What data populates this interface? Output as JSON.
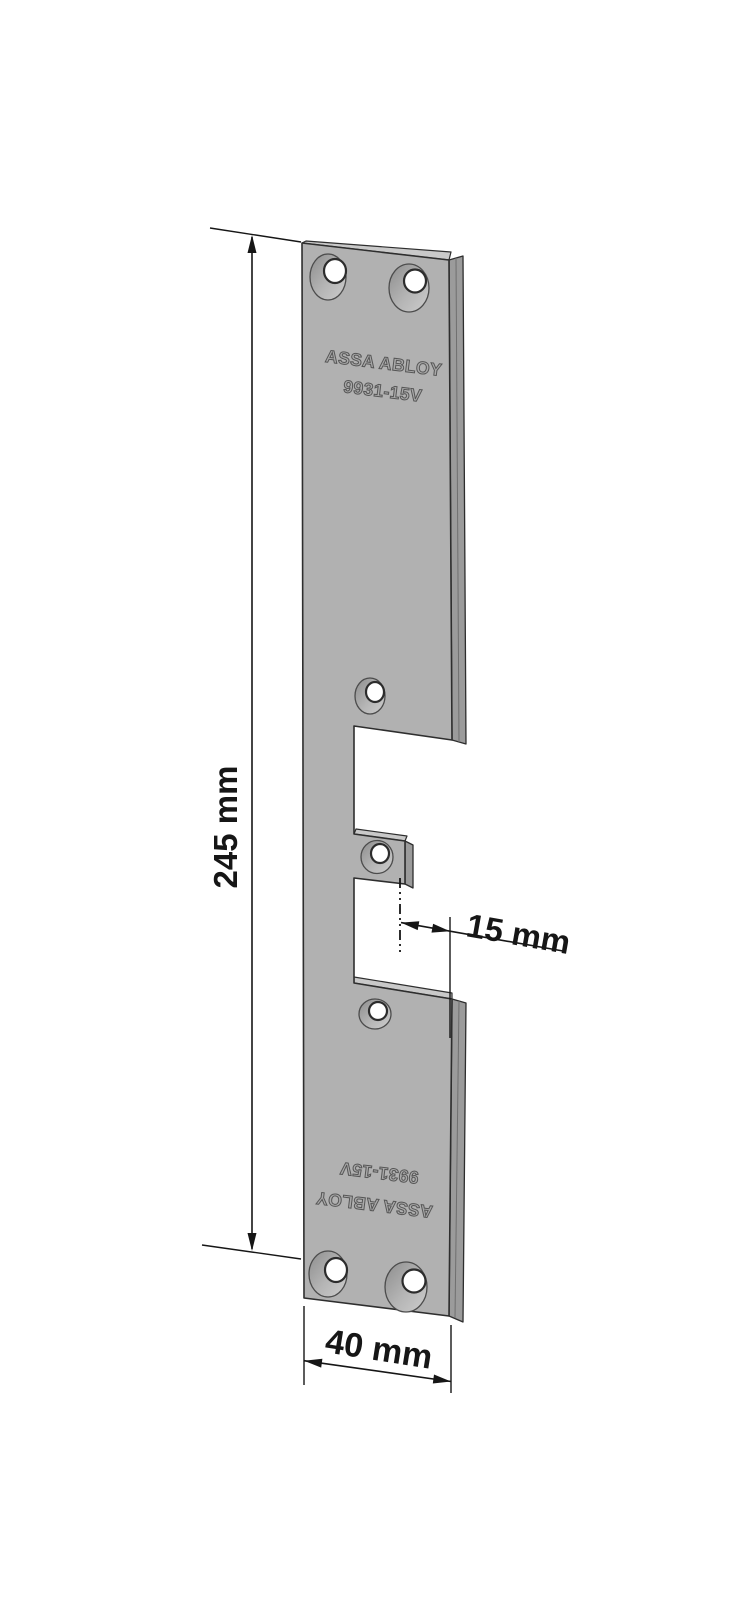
{
  "plate": {
    "brand": "ASSA ABLOY",
    "model": "9931-15V"
  },
  "dimensions": {
    "height": "245 mm",
    "strike_offset": "15 mm",
    "width": "40 mm"
  },
  "colors": {
    "background": "#ffffff",
    "plate_face": "#b1b1b1",
    "plate_side": "#9b9b9b",
    "plate_top_surface": "#c9c9c9",
    "countersink_dark": "#8d8d8d",
    "countersink_light": "#cdcdcd",
    "outline": "#2e2e2e",
    "dimension_ink": "#161616"
  }
}
